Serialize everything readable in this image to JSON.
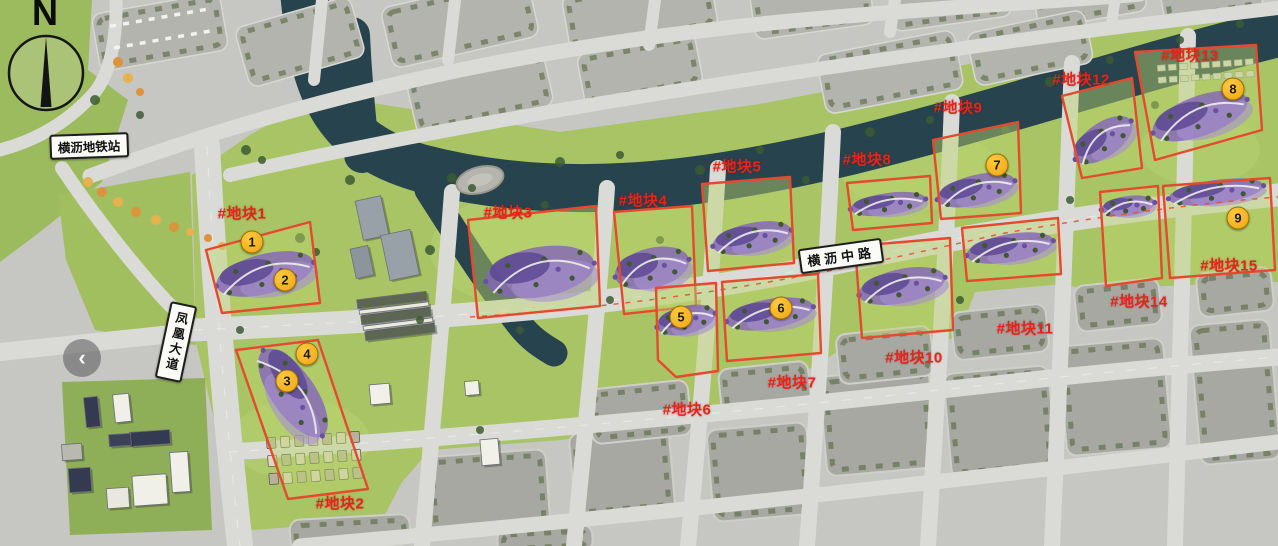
{
  "map_type": "master-plan-aerial",
  "compass": {
    "north_letter": "N"
  },
  "station_label": "横沥地铁站",
  "road_labels": {
    "vertical": "凤凰大道",
    "horizontal": "横沥中路"
  },
  "back_button": {
    "symbol": "‹"
  },
  "colors": {
    "plot_outline": "#e54a2e",
    "plot_label_text": "#e8231a",
    "marker_fill": "#f6ac1e",
    "marker_border": "#9a7000",
    "marker_text": "#1b1b1b",
    "river": "#27434e",
    "grass": "#a8c464",
    "road": "#dadad6"
  },
  "plots": [
    {
      "label": "#地块1",
      "label_x": 242,
      "label_y": 213,
      "outline": [
        [
          206,
          250
        ],
        [
          310,
          222
        ],
        [
          320,
          303
        ],
        [
          222,
          313
        ]
      ],
      "flower": {
        "cx": 265,
        "cy": 274,
        "rx": 50,
        "ry": 20,
        "angle": -14
      }
    },
    {
      "label": "#地块2",
      "label_x": 340,
      "label_y": 503,
      "outline": [
        [
          236,
          350
        ],
        [
          318,
          340
        ],
        [
          368,
          489
        ],
        [
          288,
          499
        ]
      ],
      "flower": {
        "cx": 293,
        "cy": 393,
        "rx": 52,
        "ry": 22,
        "angle": 55
      }
    },
    {
      "label": "#地块3",
      "label_x": 508,
      "label_y": 212,
      "outline": [
        [
          468,
          220
        ],
        [
          596,
          206
        ],
        [
          600,
          306
        ],
        [
          478,
          318
        ]
      ],
      "flower": {
        "cx": 540,
        "cy": 272,
        "rx": 55,
        "ry": 25,
        "angle": -10
      }
    },
    {
      "label": "#地块4",
      "label_x": 643,
      "label_y": 200,
      "outline": [
        [
          614,
          212
        ],
        [
          692,
          206
        ],
        [
          696,
          306
        ],
        [
          624,
          314
        ]
      ],
      "flower": {
        "cx": 652,
        "cy": 268,
        "rx": 38,
        "ry": 20,
        "angle": -14
      }
    },
    {
      "label": "#地块5",
      "label_x": 737,
      "label_y": 166,
      "outline": [
        [
          702,
          184
        ],
        [
          790,
          177
        ],
        [
          794,
          263
        ],
        [
          708,
          271
        ]
      ],
      "flower": {
        "cx": 752,
        "cy": 238,
        "rx": 40,
        "ry": 15,
        "angle": -12
      }
    },
    {
      "label": "#地块6",
      "label_x": 687,
      "label_y": 409,
      "outline": [
        [
          656,
          288
        ],
        [
          716,
          283
        ],
        [
          718,
          371
        ],
        [
          676,
          377
        ],
        [
          658,
          360
        ]
      ],
      "flower": {
        "cx": 686,
        "cy": 320,
        "rx": 30,
        "ry": 14,
        "angle": -14
      }
    },
    {
      "label": "#地块7",
      "label_x": 792,
      "label_y": 382,
      "outline": [
        [
          722,
          282
        ],
        [
          818,
          274
        ],
        [
          821,
          353
        ],
        [
          727,
          361
        ]
      ],
      "flower": {
        "cx": 770,
        "cy": 314,
        "rx": 44,
        "ry": 15,
        "angle": -10
      }
    },
    {
      "label": "#地块8",
      "label_x": 867,
      "label_y": 159,
      "outline": [
        [
          847,
          183
        ],
        [
          930,
          176
        ],
        [
          932,
          223
        ],
        [
          853,
          230
        ]
      ],
      "flower": {
        "cx": 888,
        "cy": 204,
        "rx": 38,
        "ry": 11,
        "angle": -8
      }
    },
    {
      "label": "#地块9",
      "label_x": 958,
      "label_y": 107,
      "outline": [
        [
          933,
          140
        ],
        [
          1018,
          122
        ],
        [
          1021,
          213
        ],
        [
          941,
          219
        ]
      ],
      "flower": {
        "cx": 976,
        "cy": 190,
        "rx": 40,
        "ry": 15,
        "angle": -14
      }
    },
    {
      "label": "#地块10",
      "label_x": 914,
      "label_y": 357,
      "outline": [
        [
          855,
          246
        ],
        [
          950,
          238
        ],
        [
          953,
          330
        ],
        [
          862,
          338
        ]
      ],
      "flower": {
        "cx": 902,
        "cy": 286,
        "rx": 44,
        "ry": 17,
        "angle": -12
      }
    },
    {
      "label": "#地块11",
      "label_x": 1025,
      "label_y": 328,
      "outline": [
        [
          962,
          228
        ],
        [
          1058,
          218
        ],
        [
          1061,
          274
        ],
        [
          967,
          281
        ]
      ],
      "flower": {
        "cx": 1010,
        "cy": 248,
        "rx": 44,
        "ry": 14,
        "angle": -10
      }
    },
    {
      "label": "#地块12",
      "label_x": 1081,
      "label_y": 79,
      "outline": [
        [
          1062,
          96
        ],
        [
          1132,
          78
        ],
        [
          1142,
          168
        ],
        [
          1082,
          178
        ]
      ],
      "flower": {
        "cx": 1103,
        "cy": 140,
        "rx": 34,
        "ry": 17,
        "angle": -35
      }
    },
    {
      "label": "#地块13",
      "label_x": 1190,
      "label_y": 55,
      "outline": [
        [
          1135,
          52
        ],
        [
          1256,
          45
        ],
        [
          1262,
          130
        ],
        [
          1155,
          160
        ]
      ],
      "flower": {
        "cx": 1200,
        "cy": 116,
        "rx": 50,
        "ry": 20,
        "angle": -20
      }
    },
    {
      "label": "#地块14",
      "label_x": 1139,
      "label_y": 301,
      "outline": [
        [
          1100,
          192
        ],
        [
          1158,
          186
        ],
        [
          1162,
          278
        ],
        [
          1106,
          286
        ]
      ],
      "flower": {
        "cx": 1128,
        "cy": 206,
        "rx": 27,
        "ry": 10,
        "angle": -8
      }
    },
    {
      "label": "#地块15",
      "label_x": 1229,
      "label_y": 265,
      "outline": [
        [
          1163,
          186
        ],
        [
          1270,
          178
        ],
        [
          1275,
          270
        ],
        [
          1170,
          278
        ]
      ],
      "flower": {
        "cx": 1216,
        "cy": 192,
        "rx": 48,
        "ry": 12,
        "angle": -8
      }
    }
  ],
  "markers": [
    {
      "num": "1",
      "x": 252,
      "y": 242
    },
    {
      "num": "2",
      "x": 285,
      "y": 280
    },
    {
      "num": "3",
      "x": 287,
      "y": 381
    },
    {
      "num": "4",
      "x": 307,
      "y": 354
    },
    {
      "num": "5",
      "x": 681,
      "y": 317
    },
    {
      "num": "6",
      "x": 781,
      "y": 308
    },
    {
      "num": "7",
      "x": 997,
      "y": 165
    },
    {
      "num": "8",
      "x": 1233,
      "y": 89
    },
    {
      "num": "9",
      "x": 1238,
      "y": 218
    }
  ]
}
